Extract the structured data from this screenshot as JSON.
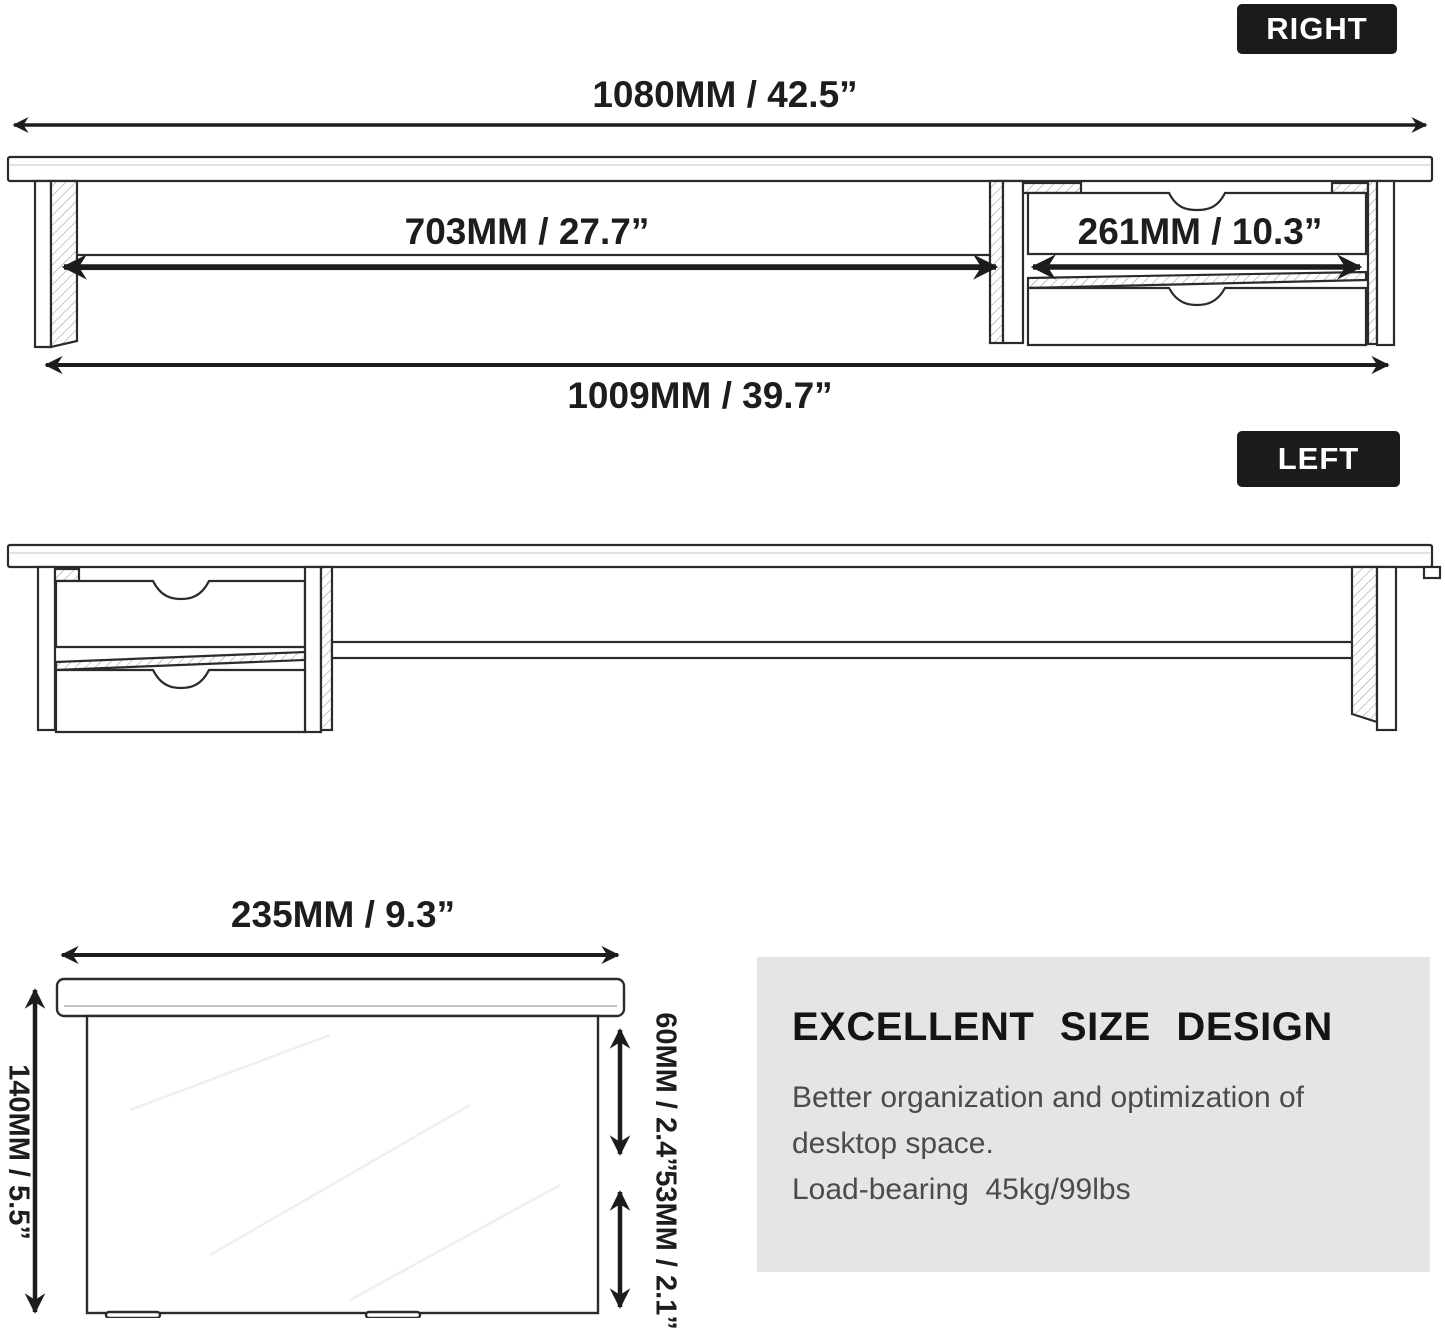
{
  "badges": {
    "right": "RIGHT",
    "left": "LEFT"
  },
  "labels": {
    "dim_1080": "1080MM / 42.5”",
    "dim_703": "703MM / 27.7”",
    "dim_261": "261MM / 10.3”",
    "dim_1009": "1009MM / 39.7”",
    "dim_235": "235MM / 9.3”",
    "dim_140": "140MM / 5.5”",
    "dim_60": "60MM / 2.4”",
    "dim_53": "53MM / 2.1”"
  },
  "panel": {
    "heading": "EXCELLENT SIZE DESIGN",
    "line1": "Better organization and optimization of",
    "line2": "desktop space.",
    "line3": "Load-bearing  45kg/99lbs"
  },
  "colors": {
    "line_art": "#2b2b2b",
    "arrow": "#1c1c1c",
    "badge_bg": "#1b1b1b",
    "badge_text": "#ffffff",
    "panel_bg": "#e5e5e5",
    "panel_heading": "#141414",
    "panel_text": "#4b4b4b"
  }
}
